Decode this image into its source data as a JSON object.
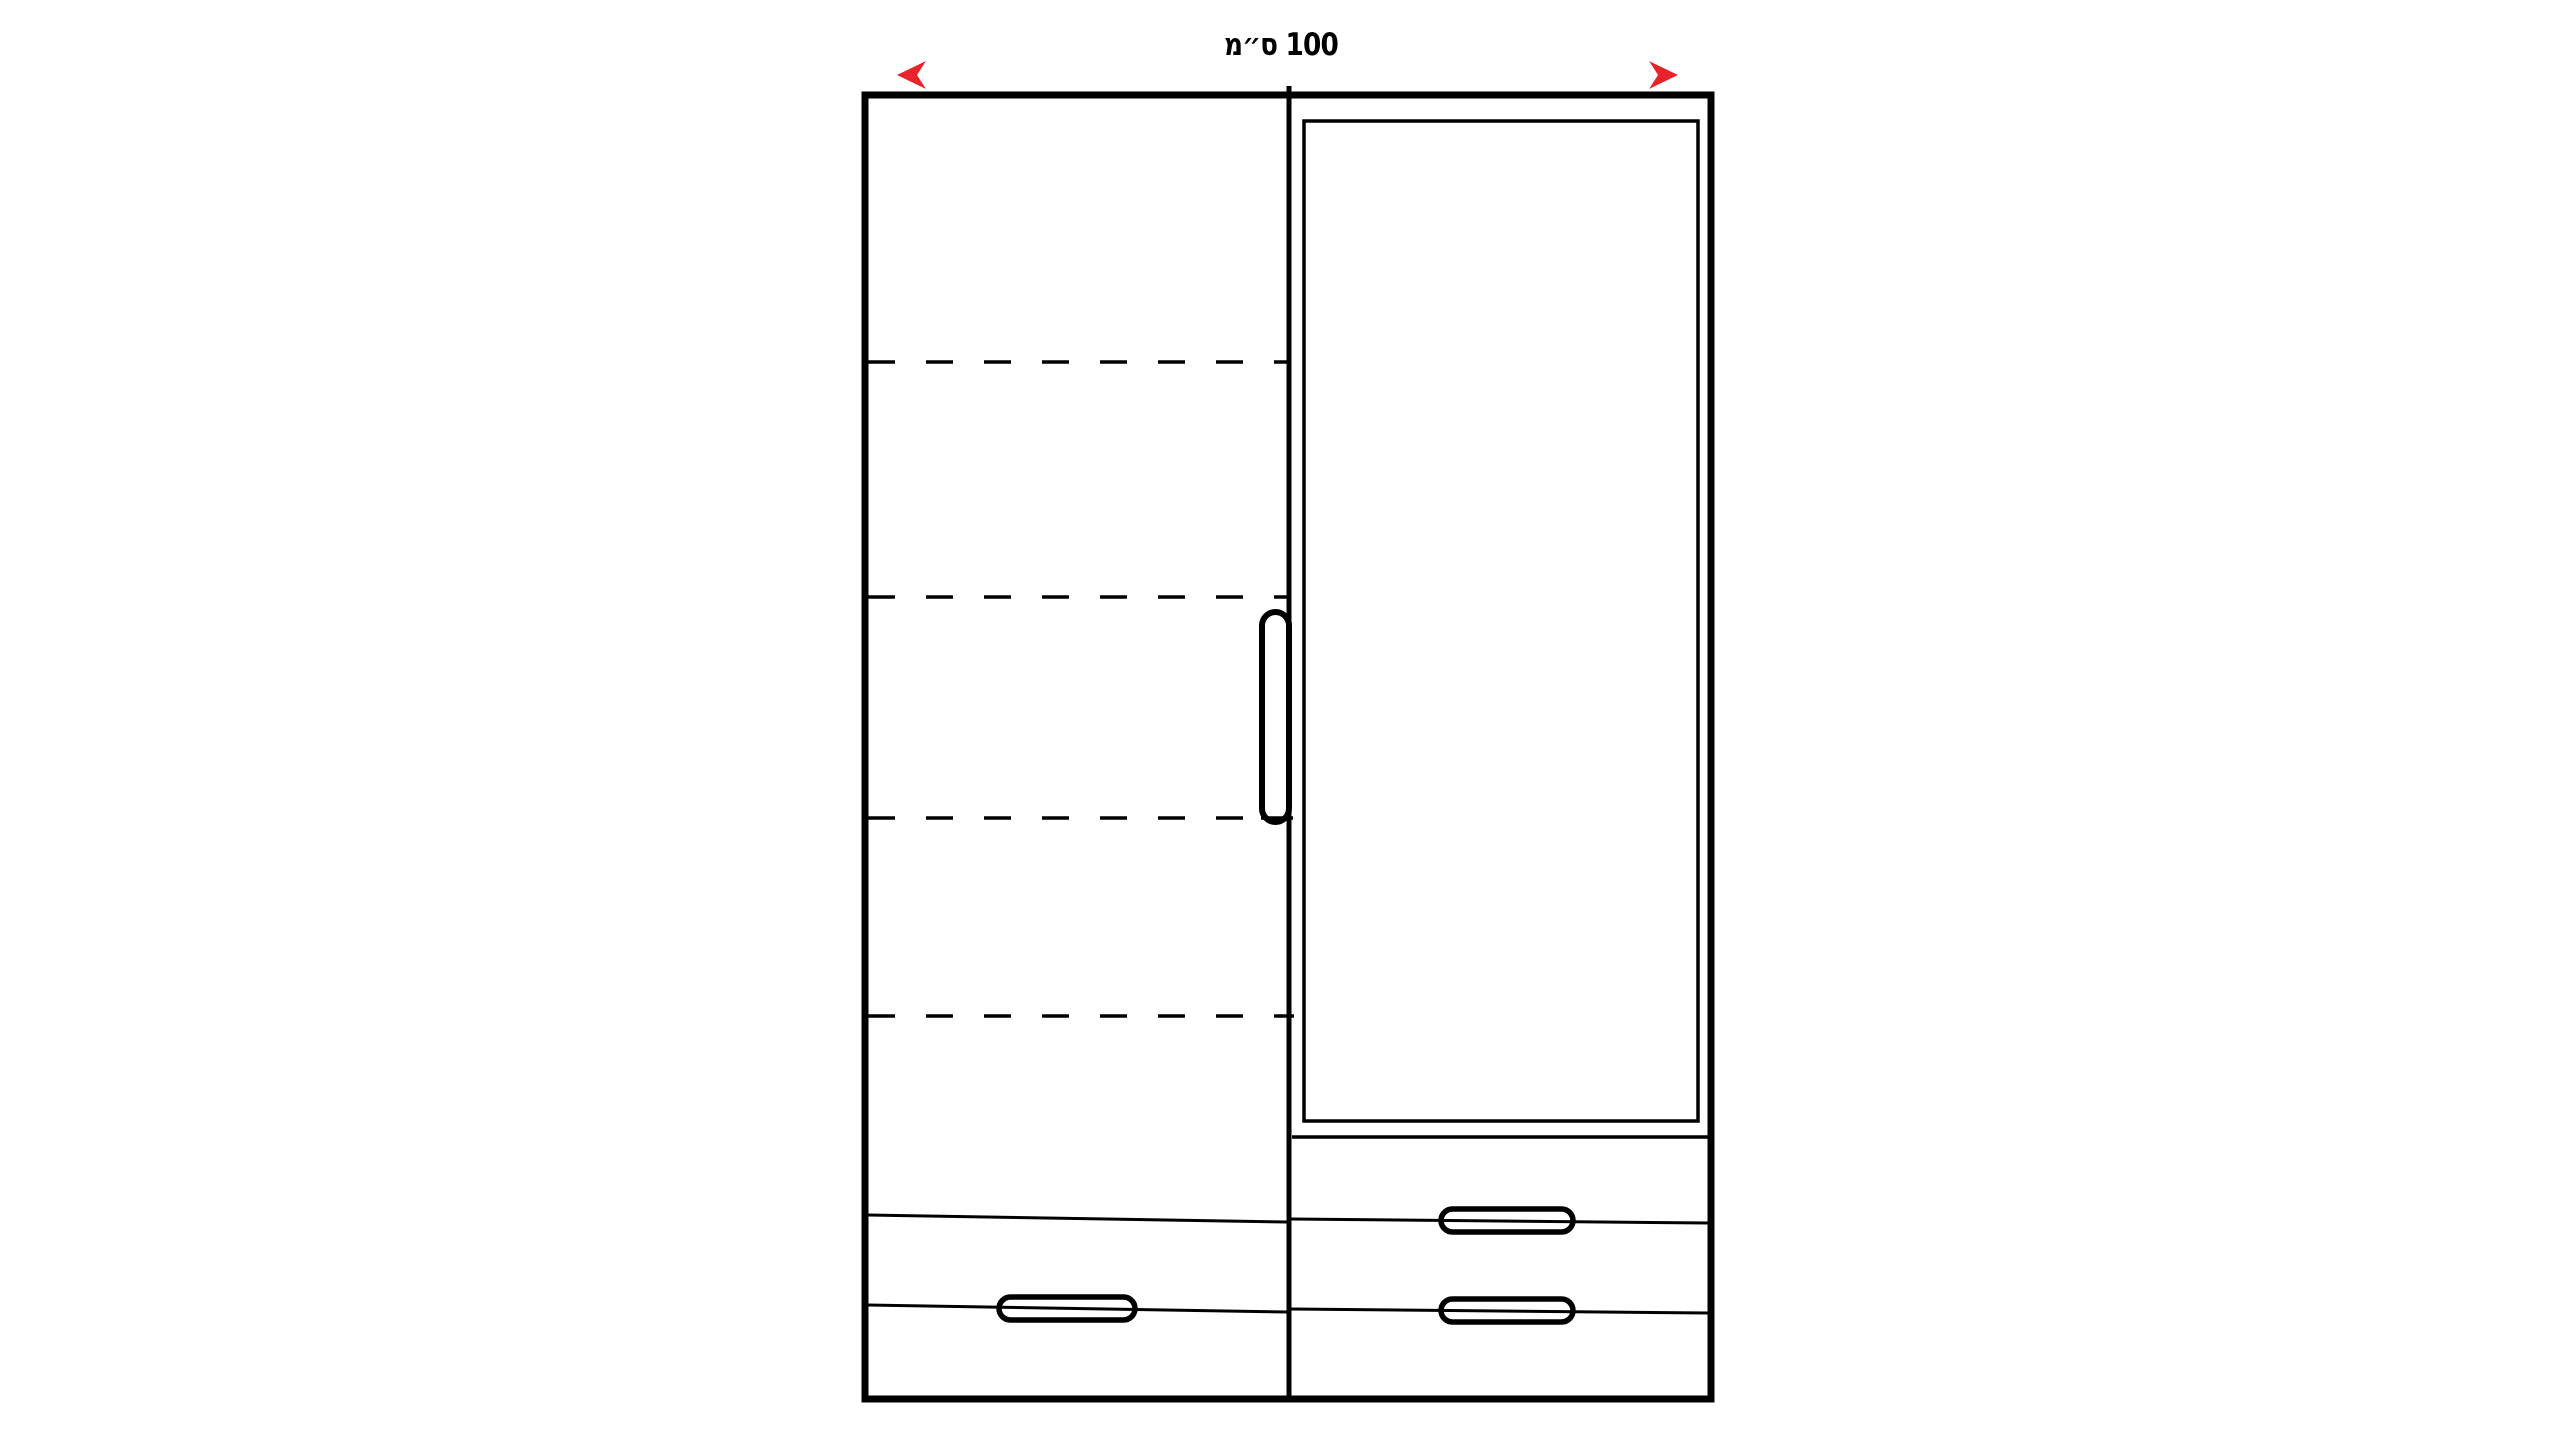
{
  "canvas": {
    "width": 2560,
    "height": 1440,
    "background": "#ffffff"
  },
  "colors": {
    "line": "#000000",
    "panel_fill": "#ffffff",
    "arrow_red": "#e8232b",
    "arrow_dark": "#8f1219"
  },
  "dimension": {
    "label": "100 ס״מ"
  },
  "icons": {
    "dimension_arrow": "double-headed-horizontal-arrow"
  },
  "structure": {
    "left_section": {
      "dashed_shelf_lines": 4,
      "door_handles": 1,
      "drawer_divider_lines": 2,
      "drawer_handles": 1
    },
    "right_section": {
      "door_panel_frames": 1,
      "drawer_divider_lines": 2,
      "drawer_handles": 2
    }
  }
}
